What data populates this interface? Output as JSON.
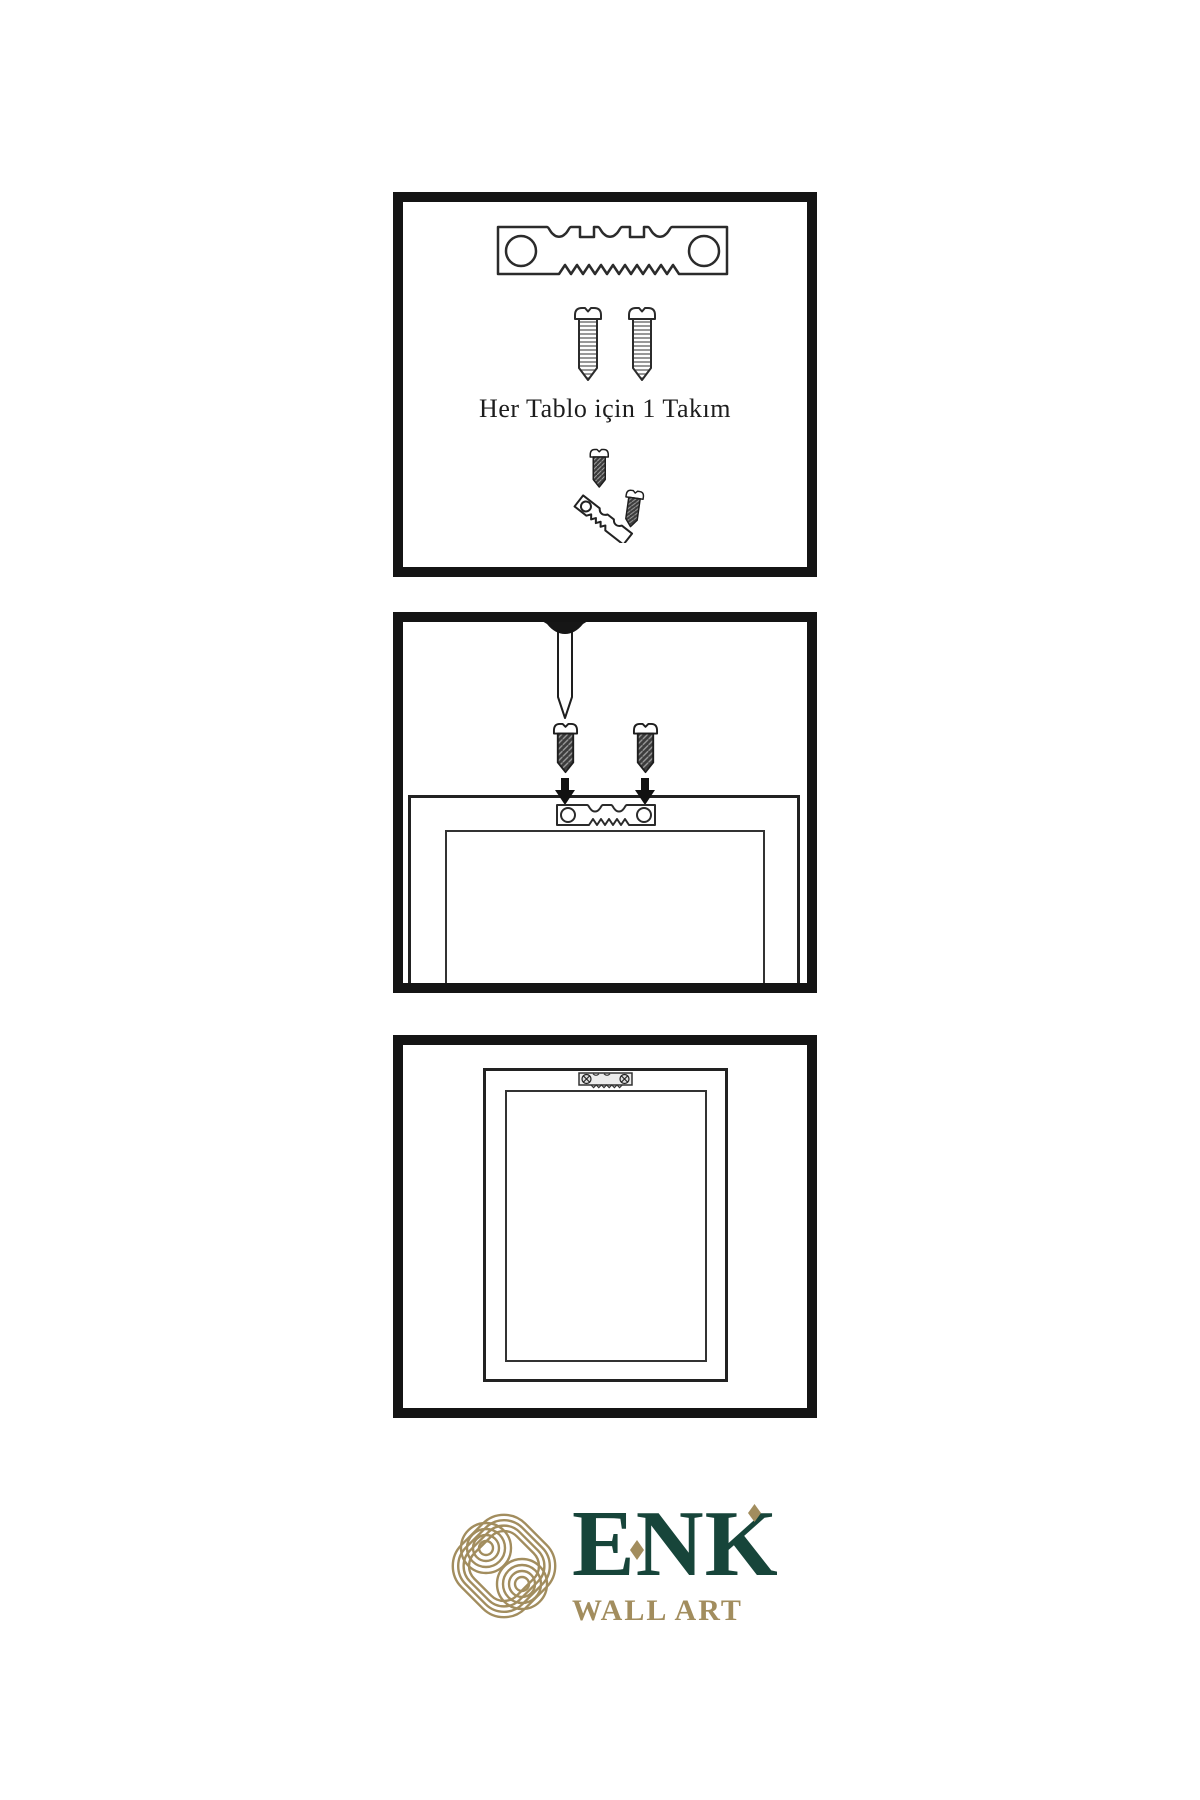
{
  "meta": {
    "type": "wall-art hanging instruction sheet"
  },
  "colors": {
    "panel_border": "#141414",
    "line_art": "#2b2b2b",
    "brand_green": "#17453a",
    "brand_gold": "#a28d5e"
  },
  "steps": {
    "step1": {
      "caption": "Her Tablo için 1 Takım",
      "icons": [
        "sawtooth-hanger-icon",
        "mounting-screw-icon",
        "mounting-screw-icon",
        "hanger-assembly-icon"
      ]
    },
    "step2": {
      "icons": [
        "wall-nail-icon",
        "mounting-screw-icon",
        "mounting-screw-icon",
        "down-arrow-icon",
        "down-arrow-icon",
        "frame-back-icon",
        "sawtooth-hanger-icon"
      ]
    },
    "step3": {
      "icons": [
        "hanging-frame-icon",
        "mounted-sawtooth-hanger-icon"
      ]
    }
  },
  "logo": {
    "brand": "ENK",
    "subtitle": "WALL ART",
    "emblem": "knot-emblem-icon"
  }
}
